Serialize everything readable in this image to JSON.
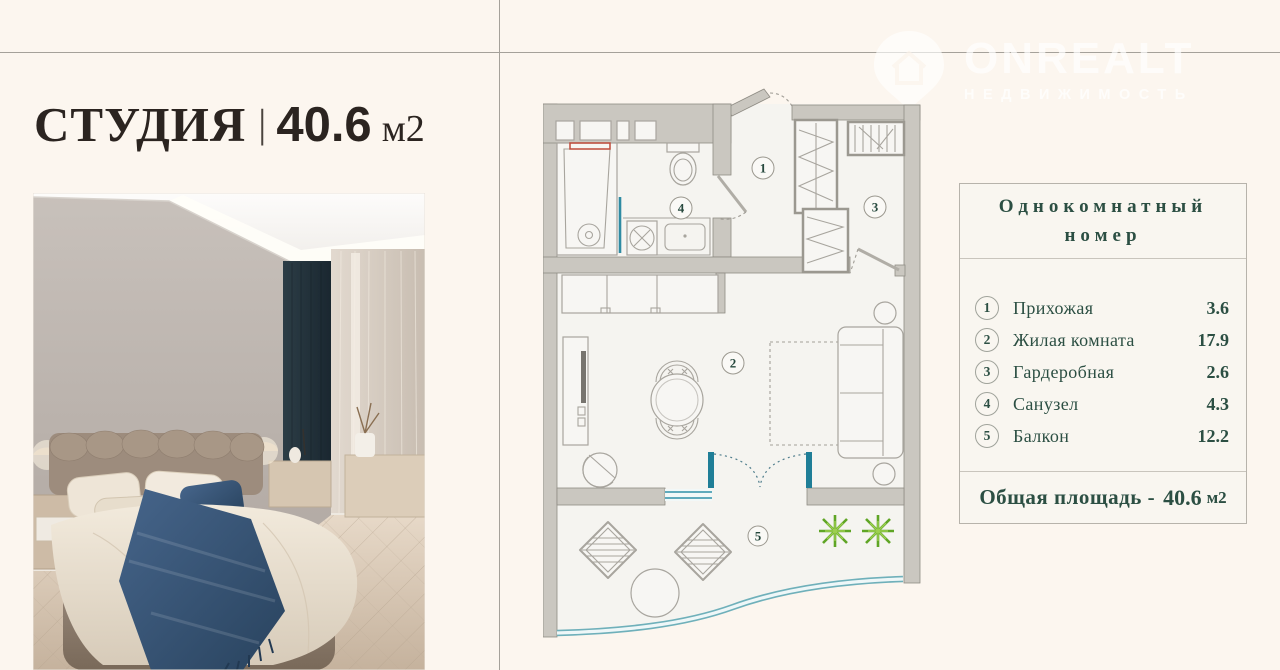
{
  "page": {
    "background": "#fcf6ef",
    "divider_color": "#a5a19a"
  },
  "title": {
    "name": "СТУДИЯ",
    "separator": "|",
    "area": "40.6",
    "unit": "м2"
  },
  "watermark": {
    "brand": "ONREALT",
    "tagline": "НЕДВИЖИМОСТЬ"
  },
  "plan": {
    "circles": [
      {
        "num": "1"
      },
      {
        "num": "2"
      },
      {
        "num": "3"
      },
      {
        "num": "4"
      },
      {
        "num": "5"
      }
    ],
    "wall_color": "#cac7c0",
    "accent_teal": "#20809b",
    "accent_green": "#6fae2d"
  },
  "panel": {
    "title_line1": "Однокомнатный",
    "title_line2": "номер",
    "items": [
      {
        "num": "1",
        "label": "Прихожая",
        "area": "3.6"
      },
      {
        "num": "2",
        "label": "Жилая комната",
        "area": "17.9"
      },
      {
        "num": "3",
        "label": "Гардеробная",
        "area": "2.6"
      },
      {
        "num": "4",
        "label": "Санузел",
        "area": "4.3"
      },
      {
        "num": "5",
        "label": "Балкон",
        "area": "12.2"
      }
    ],
    "total_label": "Общая площадь -",
    "total_value": "40.6",
    "total_unit": "м2"
  }
}
